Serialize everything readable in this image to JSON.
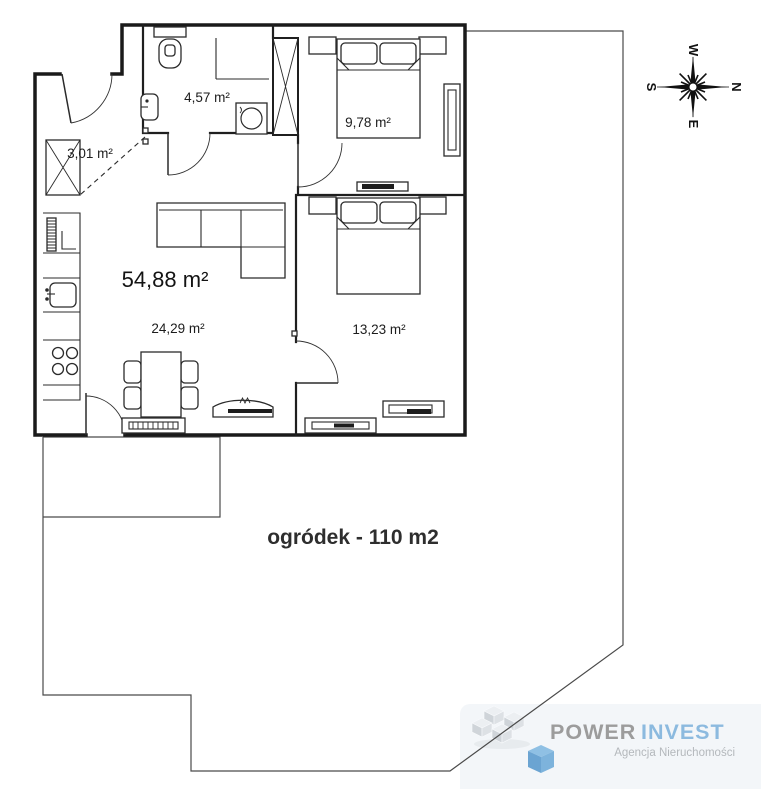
{
  "floorplan": {
    "rooms": {
      "hall": {
        "area": "3,01 m²"
      },
      "bathroom": {
        "area": "4,57 m²"
      },
      "bedroom1": {
        "area": "9,78 m²"
      },
      "living_total": {
        "area": "54,88 m²"
      },
      "living": {
        "area": "24,29 m²"
      },
      "bedroom2": {
        "area": "13,23 m²"
      }
    },
    "garden": {
      "label": "ogródek - 110 m2"
    }
  },
  "compass": {
    "top": "W",
    "right": "N",
    "bottom": "E",
    "left": "S"
  },
  "logo": {
    "brand_word1": "POWER",
    "brand_word2": "INVEST",
    "tagline": "Agencja Nieruchomości",
    "colors": {
      "word1": "#9c9c9c",
      "word2": "#8cbadf",
      "tagline": "#b4b8bc",
      "cube_blue": "#74a9d4",
      "cube_gray": "#d5dade",
      "panel_bg": "#f3f6f9"
    }
  },
  "drawing_colors": {
    "walls": "#1a1a1a",
    "furniture": "#2b2b2b",
    "garden_line": "#4a4a4a",
    "label_text": "#1c1c1c"
  }
}
